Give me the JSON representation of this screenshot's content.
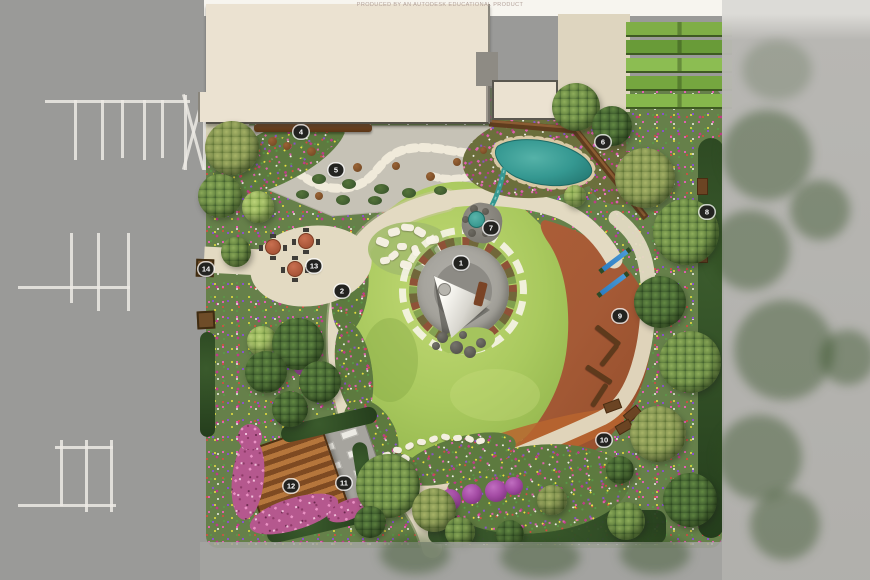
{
  "watermark": {
    "text": "PRODUCED BY AN AUTODESK EDUCATIONAL PRODUCT"
  },
  "plan": {
    "markers": [
      {
        "label": "1",
        "x": 461,
        "y": 263
      },
      {
        "label": "2",
        "x": 342,
        "y": 291
      },
      {
        "label": "4",
        "x": 301,
        "y": 132
      },
      {
        "label": "5",
        "x": 336,
        "y": 170
      },
      {
        "label": "6",
        "x": 603,
        "y": 142
      },
      {
        "label": "7",
        "x": 491,
        "y": 228
      },
      {
        "label": "8",
        "x": 707,
        "y": 212
      },
      {
        "label": "9",
        "x": 620,
        "y": 316
      },
      {
        "label": "10",
        "x": 604,
        "y": 440
      },
      {
        "label": "11",
        "x": 344,
        "y": 483
      },
      {
        "label": "12",
        "x": 291,
        "y": 486
      },
      {
        "label": "13",
        "x": 314,
        "y": 266
      },
      {
        "label": "14",
        "x": 206,
        "y": 269
      }
    ]
  },
  "colors": {
    "asphalt": "#9a9a98",
    "road_stripe": "#eceae4",
    "building": "#ebe2d1",
    "gravel": "#c6c2b6",
    "path": "#e3dac2",
    "water": "#359891",
    "mulch": "#a55a36",
    "wall": "#5f3d1e",
    "plaza": "#a9a7a1",
    "deck_light": "#b5763c",
    "deck_dark": "#7e4a22",
    "lawn": "#a9c95e",
    "lawn_deep": "#8fb24a",
    "marker_bg": "#232320",
    "marker_text": "#ffffff"
  }
}
